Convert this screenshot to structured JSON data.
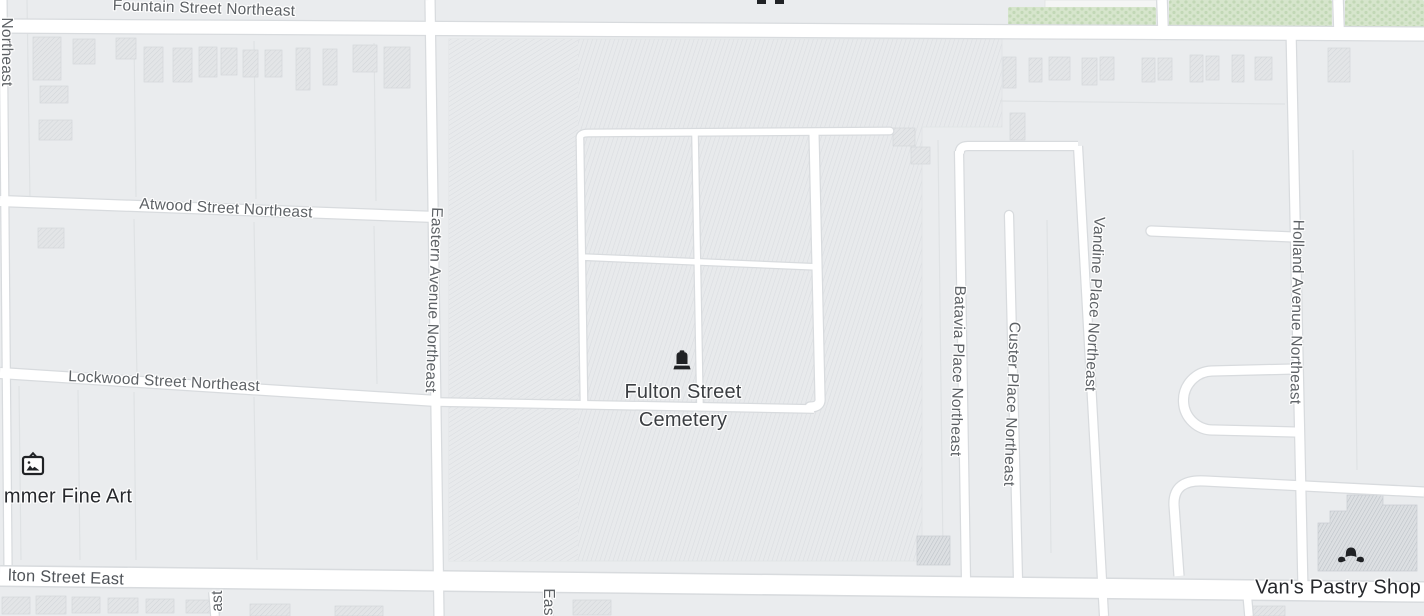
{
  "streets": {
    "fountain": "Fountain Street Northeast",
    "atwood": "Atwood Street Northeast",
    "lockwood": "Lockwood Street Northeast",
    "eastern": "Eastern Avenue Northeast",
    "batavia": "Batavia Place Northeast",
    "custer": "Custer Place Northeast",
    "vandine": "Vandine Place Northeast",
    "holland": "Holland Avenue Northeast",
    "fulton_east": "lton Street East",
    "edge_fragment_west": "Northeast",
    "edge_fragment_south_left": "ast",
    "edge_fragment_south_mid": "Eas"
  },
  "pois": {
    "cemetery": {
      "name": "Fulton Street\nCemetery",
      "icon": "tombstone-icon"
    },
    "fine_art": {
      "name": "mmer Fine Art",
      "icon": "art-gallery-icon"
    },
    "pastry_shop": {
      "name": "Van's Pastry Shop",
      "icon": "croissant-icon"
    }
  },
  "colors": {
    "road": "#ffffff",
    "road_casing": "#d8dbde",
    "block": "#eaecee",
    "cemetery_fill": "#e8eaec",
    "cemetery_hatch": "#d9dce0",
    "green": "#d6e5cc",
    "green_dot": "#c2d8b6",
    "building_fill": "#e3e5e7",
    "building_stroke": "#d5d8db",
    "building_dark": "#dcdfe2",
    "building_dark_hatch": "#bcc1c7",
    "street_label": "#5d6165",
    "poi_label": "#27292d",
    "cemetery_label": "#3b3e42",
    "icon": "#202225"
  }
}
